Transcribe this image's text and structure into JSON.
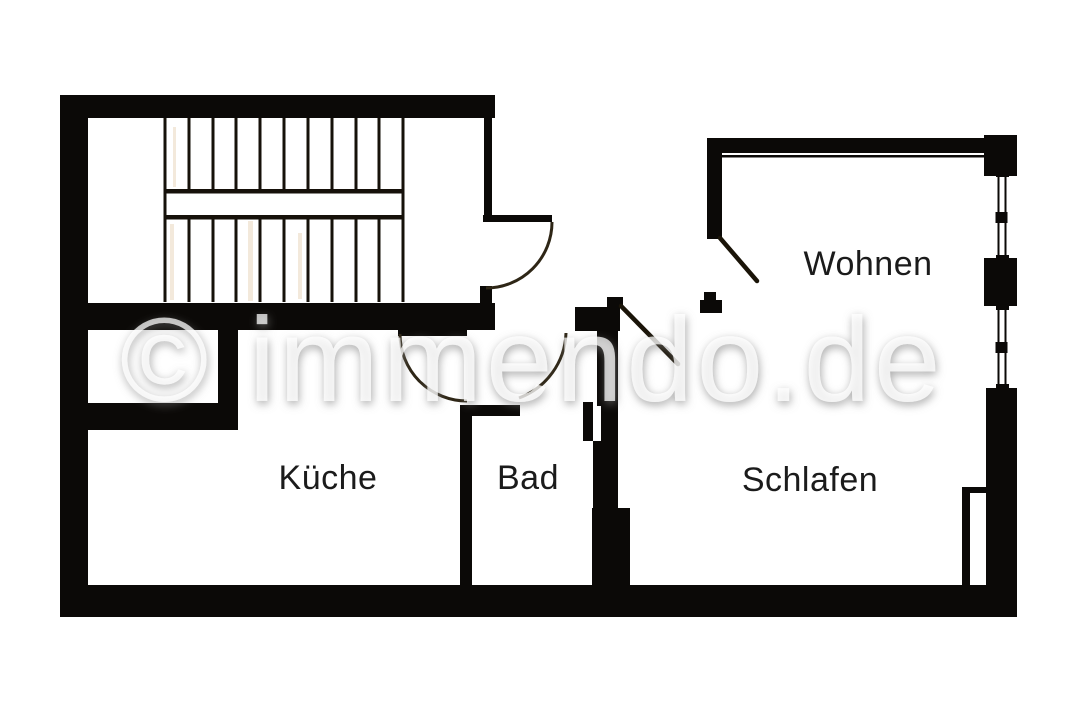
{
  "floorplan": {
    "watermark_text": "© immendo.de",
    "rooms": [
      {
        "id": "wohnen",
        "label": "Wohnen"
      },
      {
        "id": "kueche",
        "label": "Küche"
      },
      {
        "id": "bad",
        "label": "Bad"
      },
      {
        "id": "schlafen",
        "label": "Schlafen"
      }
    ],
    "colors": {
      "background": "#ffffff",
      "wall": "#0b0907",
      "stair_line": "#16110a",
      "door_line": "#2e2616",
      "door_leaf": "#1a1408",
      "room_label": "#1b1b1b",
      "watermark_white": "#ffffff",
      "watermark_shadow": "#7a7a7a",
      "scan_artifact": "#d0a66e"
    },
    "symbols": {
      "staircase_flights": 2,
      "staircase_treads_per_flight": 10,
      "window_count": 2,
      "door_swing_arcs": 3,
      "door_leaf_lines": 2
    }
  }
}
